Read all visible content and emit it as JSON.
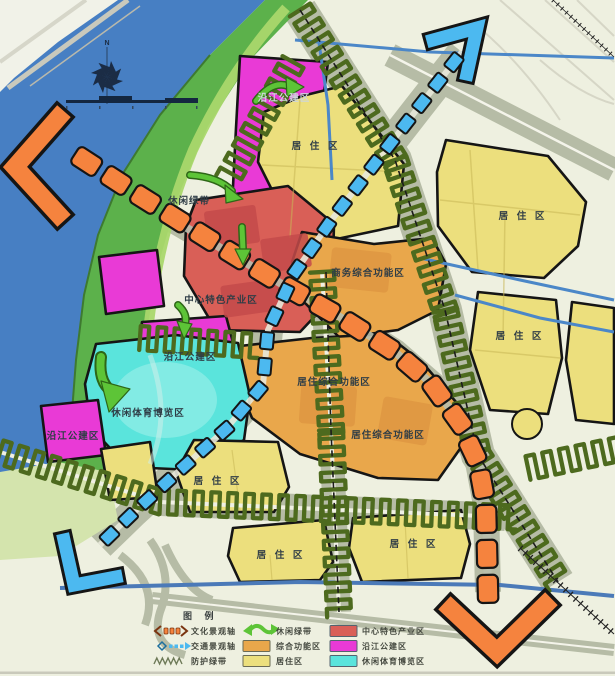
{
  "map": {
    "labels": {
      "riverside_public_top": "沿江公建区",
      "residential_top": "居 住 区",
      "leisure_green_belt": "休闲绿带",
      "central_industry": "中心特色产业区",
      "business_complex": "商务综合功能区",
      "residential_complex_1": "居住综合功能区",
      "residential_complex_2": "居住综合功能区",
      "riverside_public_mid": "沿江公建区",
      "leisure_sports_expo": "休闲体育博览区",
      "riverside_public_left": "沿江公建区",
      "residential_top_right": "居 住 区",
      "residential_right": "居 住 区",
      "residential_bottom_left": "居 住 区",
      "residential_bottom_mid": "居 住 区",
      "residential_bottom_right": "居 住 区"
    },
    "compass": {
      "north": "N"
    }
  },
  "legend": {
    "title": "图 例",
    "items": [
      {
        "symbol": "culture-axis-symbol",
        "label": "文化景观轴"
      },
      {
        "symbol": "traffic-axis-symbol",
        "label": "交通景观轴"
      },
      {
        "symbol": "protection-green-symbol",
        "label": "防护绿带"
      },
      {
        "symbol": "leisure-green-symbol",
        "label": "休闲绿带"
      },
      {
        "symbol": "swatch-comprehensive",
        "label": "综合功能区"
      },
      {
        "symbol": "swatch-residential",
        "label": "居住区"
      },
      {
        "symbol": "swatch-central-industry",
        "label": "中心特色产业区"
      },
      {
        "symbol": "swatch-riverside-public",
        "label": "沿江公建区"
      },
      {
        "symbol": "swatch-leisure-expo",
        "label": "休闲体育博览区"
      }
    ]
  },
  "colors": {
    "background": "#eef0e0",
    "river": "#477fc3",
    "bank_green": "#5cb14b",
    "bank_light": "#a8d66b",
    "fabric": "#b6bca6",
    "residential": "#ecdf7d",
    "comprehensive": "#e9a74b",
    "central_industry": "#d95f57",
    "riverside_public": "#e93ad6",
    "leisure_expo": "#5ae4dc",
    "culture_axis": "#f5833e",
    "traffic_axis": "#4cb9f0",
    "green_belt": "#4d6a1e",
    "leisure_arrow": "#5dc437",
    "label": "#2f3d46"
  }
}
